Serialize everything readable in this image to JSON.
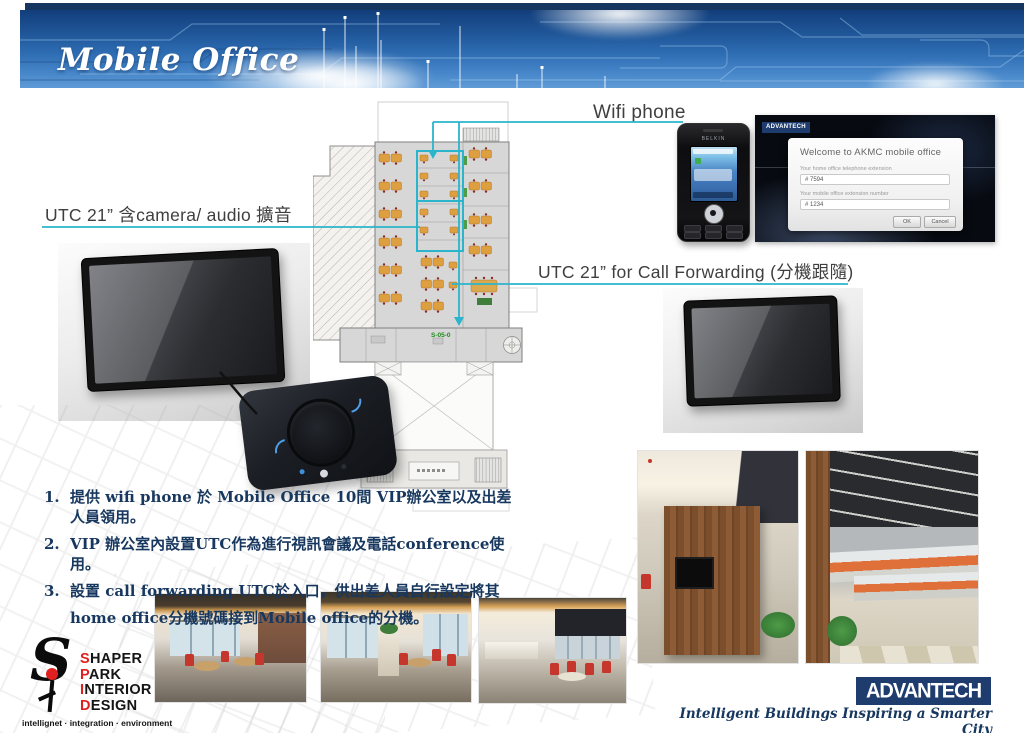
{
  "slide": {
    "title": "Mobile Office"
  },
  "annotations": {
    "wifi_phone": "Wifi phone",
    "utc_camera": "UTC 21”  含camera/ audio 擴音",
    "utc_forwarding": "UTC 21”  for Call Forwarding (分機跟隨)"
  },
  "phone": {
    "brand": "BELKIN"
  },
  "floor_plan": {
    "entrance_code": "S-05-0"
  },
  "login_screen": {
    "brand": "ADVANTECH",
    "title": "Welcome to AKMC mobile office",
    "home_ext_label": "Your home office telephone extension",
    "home_ext_value": "# 7594",
    "mobile_ext_label": "Your mobile office extension number",
    "mobile_ext_value": "# 1234",
    "ok_button": "OK",
    "cancel_button": "Cancel"
  },
  "notes": [
    {
      "num": "1.",
      "text": "提供 wifi phone 於 Mobile Office 10間 VIP辦公室以及出差人員領用。"
    },
    {
      "num": "2.",
      "text": "VIP 辦公室內設置UTC作為進行視訊會議及電話conference使用。"
    },
    {
      "num": "3.",
      "text": "設置 call forwarding UTC於入口，供出差人員自行設定將其"
    },
    {
      "num": "",
      "text": "home office分機號碼接到Mobile office的分機。"
    }
  ],
  "footer": {
    "spid": {
      "mark": "S",
      "lines": [
        {
          "first": "S",
          "rest": "HAPER"
        },
        {
          "first": "P",
          "rest": "ARK"
        },
        {
          "first": "I",
          "rest": "NTERIOR"
        },
        {
          "first": "D",
          "rest": "ESIGN"
        }
      ],
      "tagline": "intellignet · integration · environment"
    },
    "advantech": {
      "logo_text": "ADVANTECH",
      "tagline": "Intelligent Buildings Inspiring a Smarter City"
    }
  },
  "colors": {
    "accent_cyan": "#2ab5cc",
    "advantech_navy": "#1e3c6e",
    "spid_red": "#e02020",
    "note_blue": "#17375e"
  }
}
